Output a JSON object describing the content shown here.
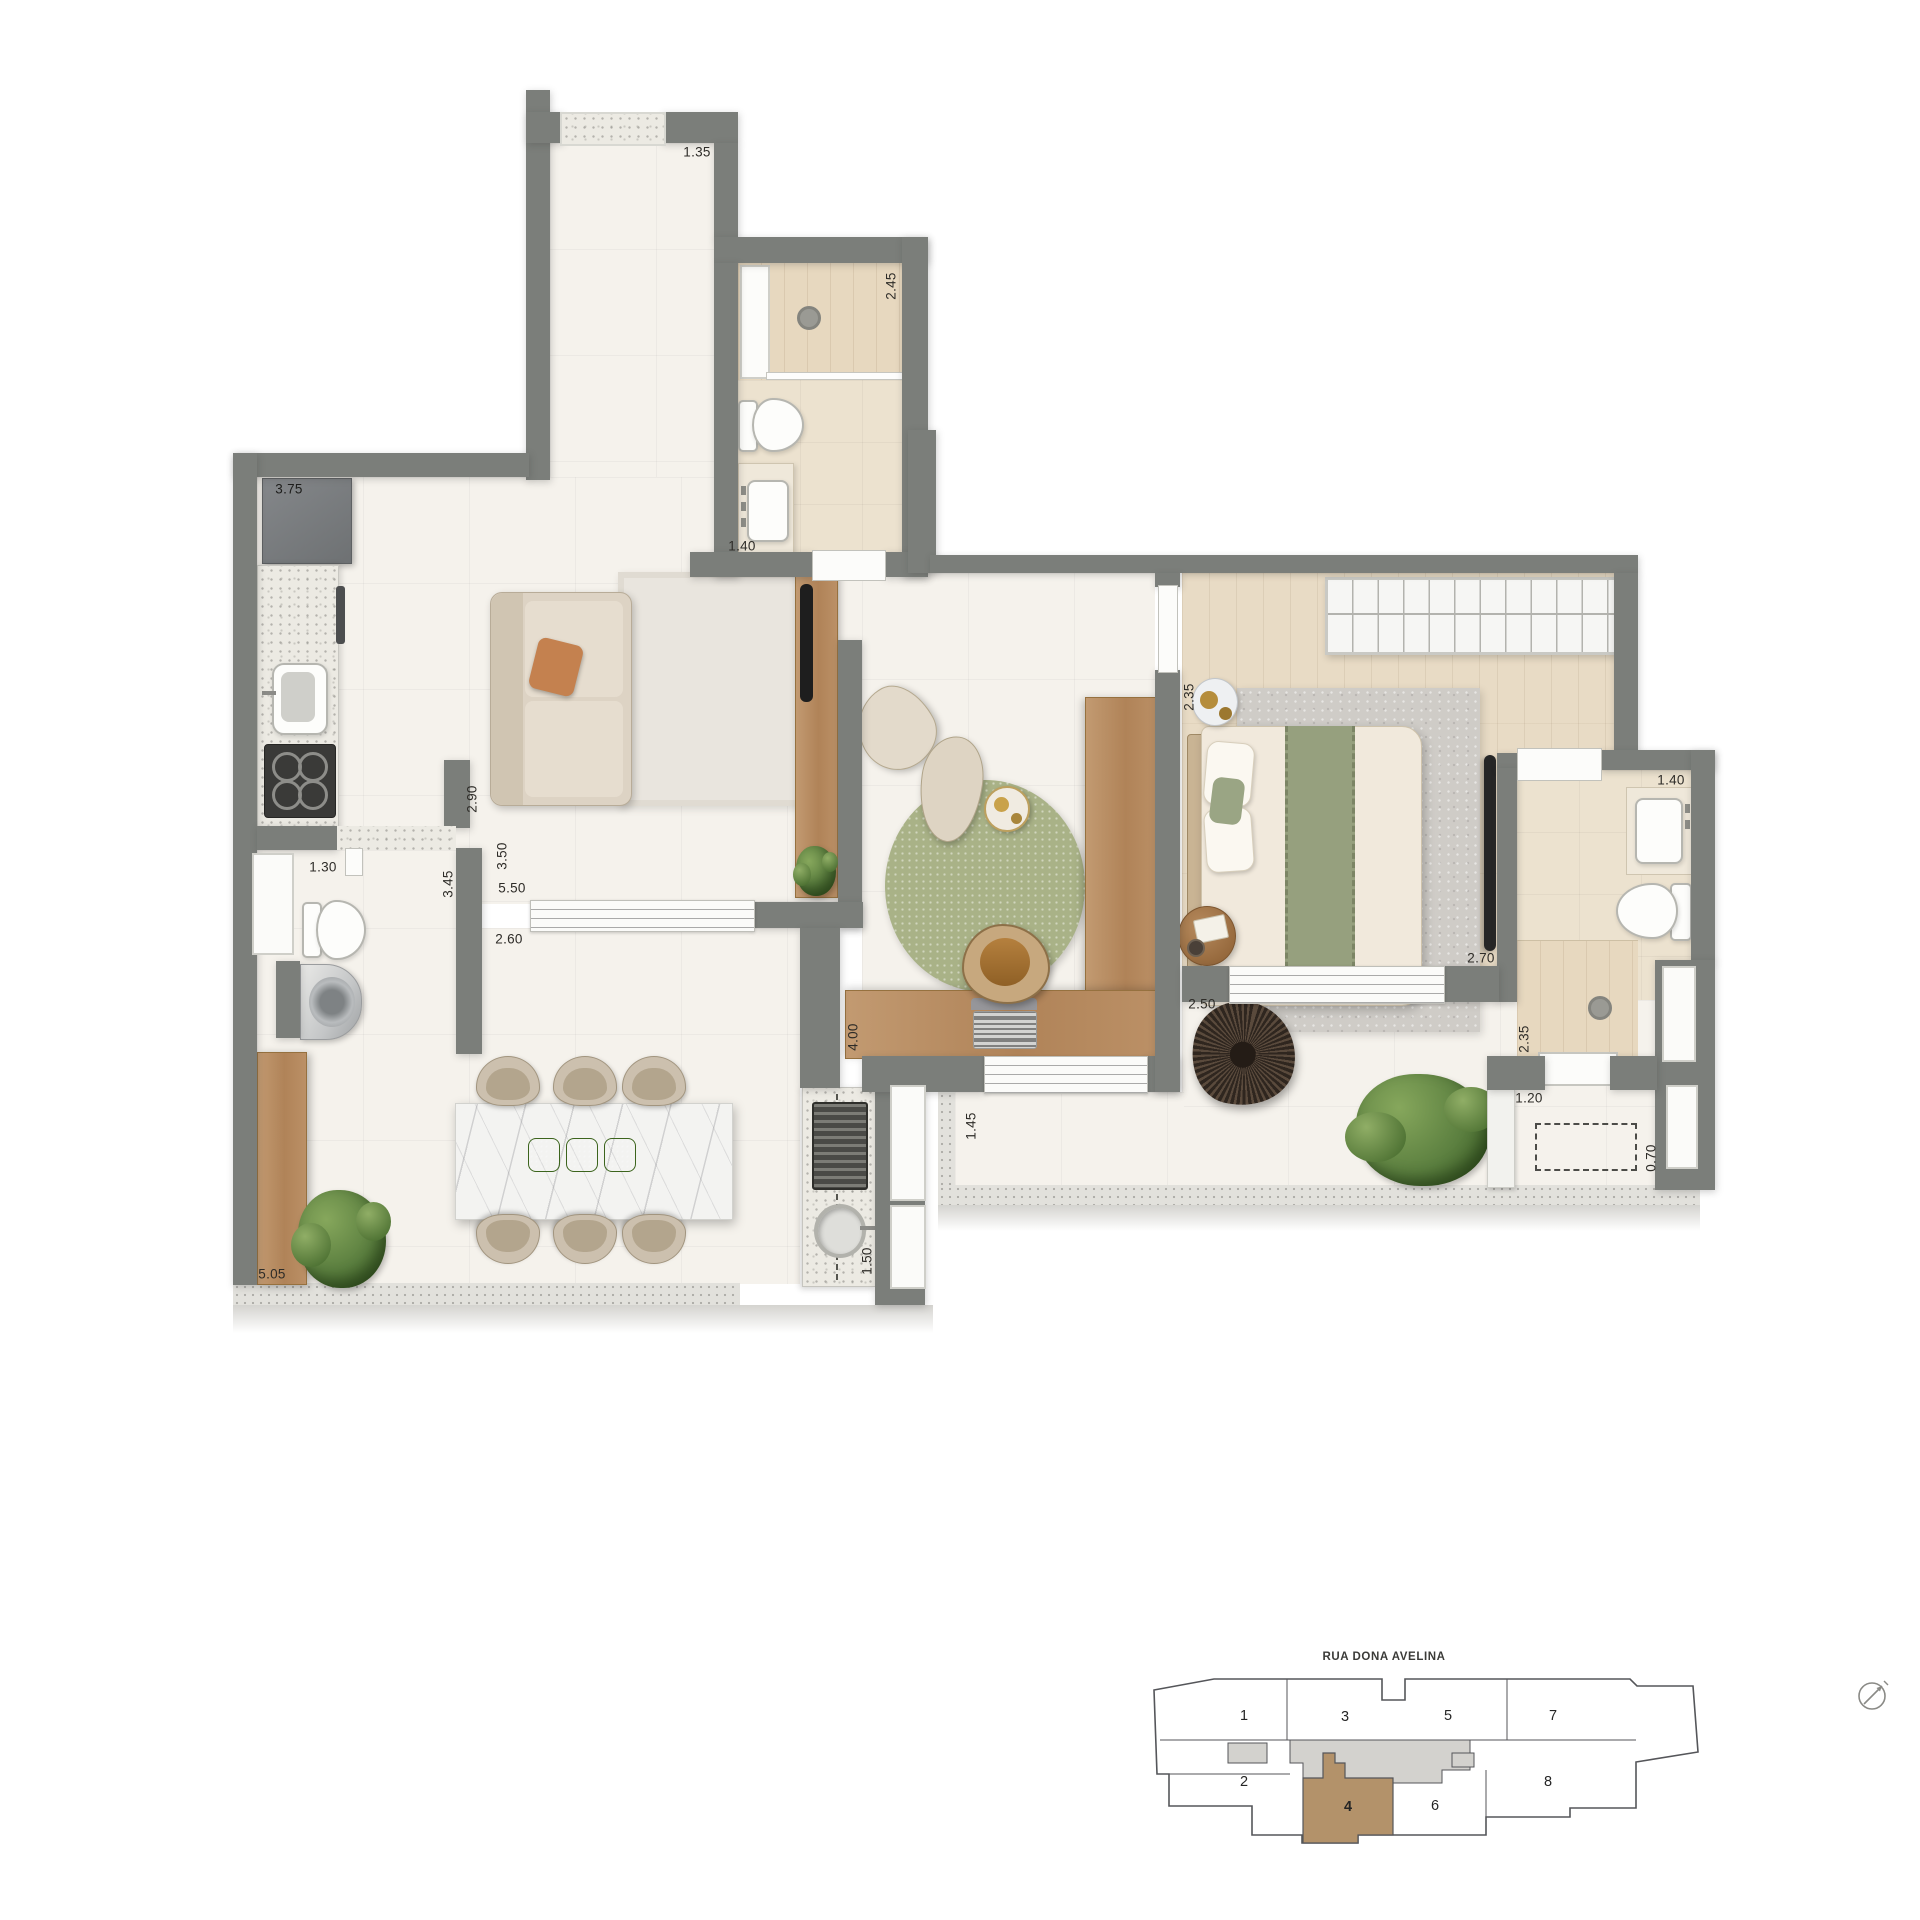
{
  "colors": {
    "wall": "#7b7e7a",
    "floor_light": "#f5f2ec",
    "floor_beige": "#ece2cf",
    "floor_wood": "#e8dbc5",
    "wood_furniture": "#b9906b",
    "rug_green": "#a9b287",
    "rug_gray": "#cfccc7",
    "accent_orange": "#c4814f",
    "marble": "#f3f3f1",
    "keyplan_highlight": "#b3926a",
    "keyplan_core": "#d3d2ce",
    "keyplan_line": "#55565a",
    "label_text": "#2e2c28"
  },
  "labels": {
    "entry_width": "1.35",
    "bath1_depth": "2.45",
    "bath1_width": "1.40",
    "kitchen_length": "3.75",
    "kitchen_pass": "2.90",
    "lavabo_width": "1.30",
    "service_depth": "3.45",
    "living_width": "3.50",
    "living_length": "5.50",
    "dining_pass": "2.60",
    "terrace_length": "5.05",
    "grill_depth": "1.50",
    "office_depth": "4.00",
    "bedroom_door": "2.35",
    "bedroom_width": "2.70",
    "balcony2_width": "2.50",
    "balcony2_depth": "1.45",
    "bath2_width": "1.40",
    "bath2_depth": "2.35",
    "balcony3_width": "1.20",
    "ac_depth": "0.70"
  },
  "keyplan": {
    "street_name": "RUA DONA AVELINA",
    "highlighted_unit": "4",
    "units": [
      {
        "number": "1"
      },
      {
        "number": "2"
      },
      {
        "number": "3"
      },
      {
        "number": "4"
      },
      {
        "number": "5"
      },
      {
        "number": "6"
      },
      {
        "number": "7"
      },
      {
        "number": "8"
      }
    ],
    "compass_icon": "north-arrow"
  }
}
